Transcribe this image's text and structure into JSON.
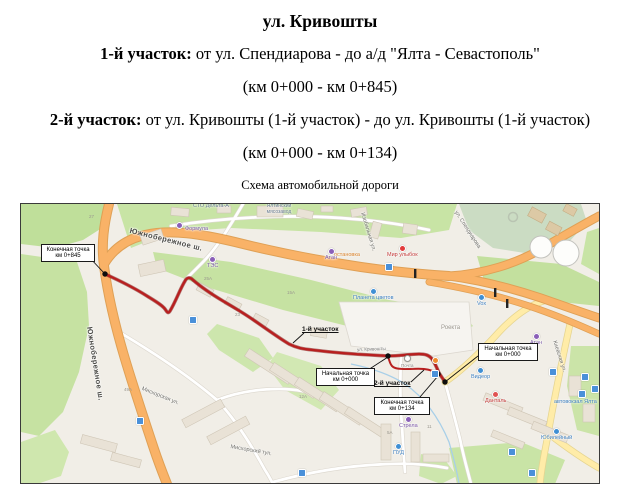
{
  "header": {
    "title": "ул. Кривошты",
    "section1": {
      "label": "1-й участок:",
      "rest": " от ул. Спендиарова - до а/д \"Ялта - Севастополь\"",
      "km": "(км 0+000 - км 0+845)"
    },
    "section2": {
      "label": "2-й участок:",
      "rest": " от ул. Кривошты (1-й участок) - до ул. Кривошты (1-й участок)",
      "km": "(км 0+000 - км 0+134)"
    },
    "map_caption": "Схема автомобильной дороги"
  },
  "map": {
    "callouts": {
      "end_845": {
        "line1": "Конечная точка",
        "line2": "км 0+845"
      },
      "start_uch2": {
        "line1": "Начальная точка",
        "line2": "км 0+000"
      },
      "end_uch2": {
        "line1": "Конечная точка",
        "line2": "км 0+134"
      },
      "start_uch1": {
        "line1": "Начальная точка",
        "line2": "км 0+000"
      }
    },
    "section_labels": {
      "s1": "1-й участок",
      "s2": "2-й участок"
    },
    "streets": {
      "s0": "Южнобережное ш.",
      "s1": "Южнобережное ш.",
      "s2": "ул. Спендиарова",
      "s3": "Изобильная ул.",
      "s4": "Мисхорская ул.",
      "s5": "Мисхорский туп.",
      "s6": "Киевская ул.",
      "s7": "ул. Кривошты"
    },
    "poi": [
      {
        "label": "СТО Дельта-А"
      },
      {
        "label": "Формула"
      },
      {
        "label": "Ялтинский мясозавод"
      },
      {
        "label": "ТЭС"
      },
      {
        "label": "остановка"
      },
      {
        "label": "Атан"
      },
      {
        "label": "Мир улыбок"
      },
      {
        "label": "Планета цветов"
      },
      {
        "label": "Vox"
      },
      {
        "label": "Роекта"
      },
      {
        "label": "Атан"
      },
      {
        "label": "Почта"
      },
      {
        "label": "Видеор"
      },
      {
        "label": "Данталь"
      },
      {
        "label": "автовокзал Ялта"
      },
      {
        "label": "Юбилейный"
      },
      {
        "label": "Стрела"
      },
      {
        "label": "ПУД"
      }
    ],
    "building_numbers": [
      "27",
      "25А",
      "23",
      "15А",
      "49А",
      "12А",
      "5А",
      "11"
    ]
  },
  "colors": {
    "route_red": "#b81f1f",
    "highway_orange": "#f9b267",
    "road_yellow": "#ffeca8",
    "green": "#c6e2a2",
    "leader_black": "#111111"
  }
}
